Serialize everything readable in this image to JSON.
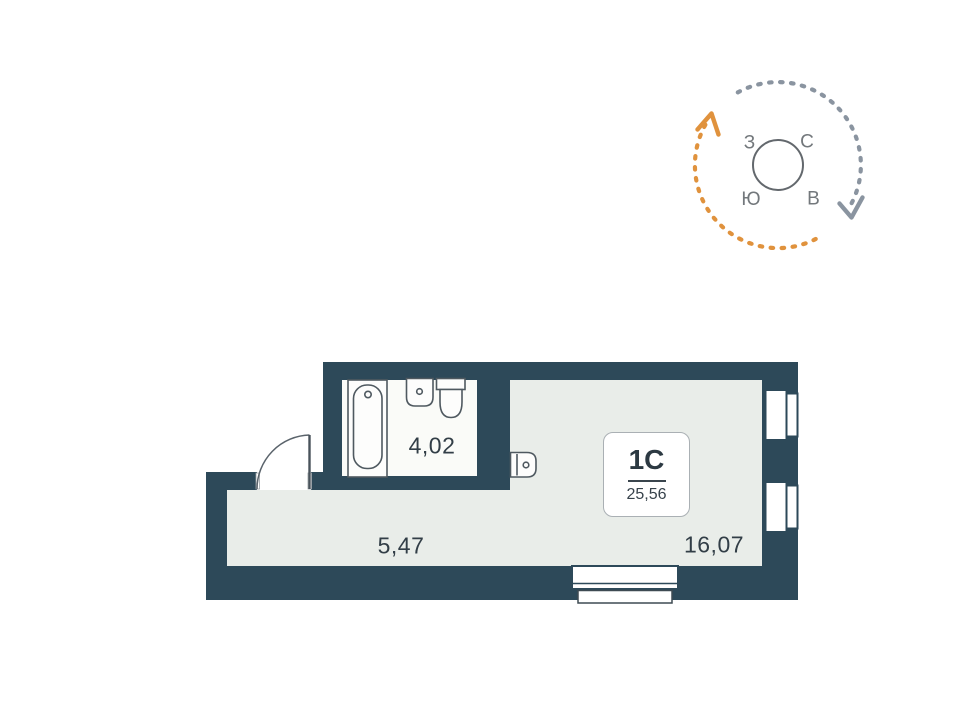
{
  "plan": {
    "unit": {
      "type_label": "1С",
      "total_area": "25,56"
    },
    "rooms": [
      {
        "name": "bathroom",
        "area": "4,02"
      },
      {
        "name": "hallway",
        "area": "5,47"
      },
      {
        "name": "living-room",
        "area": "16,07"
      }
    ],
    "colors": {
      "wall": "#2d4959",
      "floor": "#e9ede9",
      "bathroom_floor": "#fafbf8",
      "fixture_stroke": "#4f5960",
      "label_text": "#323e47"
    }
  },
  "compass": {
    "letters": {
      "north": "С",
      "east": "В",
      "south": "Ю",
      "west": "З"
    },
    "colors": {
      "orange_arc": "#e0923d",
      "gray_arc": "#8a94a0",
      "ring": "#63686d",
      "letters": "#73787c"
    }
  }
}
